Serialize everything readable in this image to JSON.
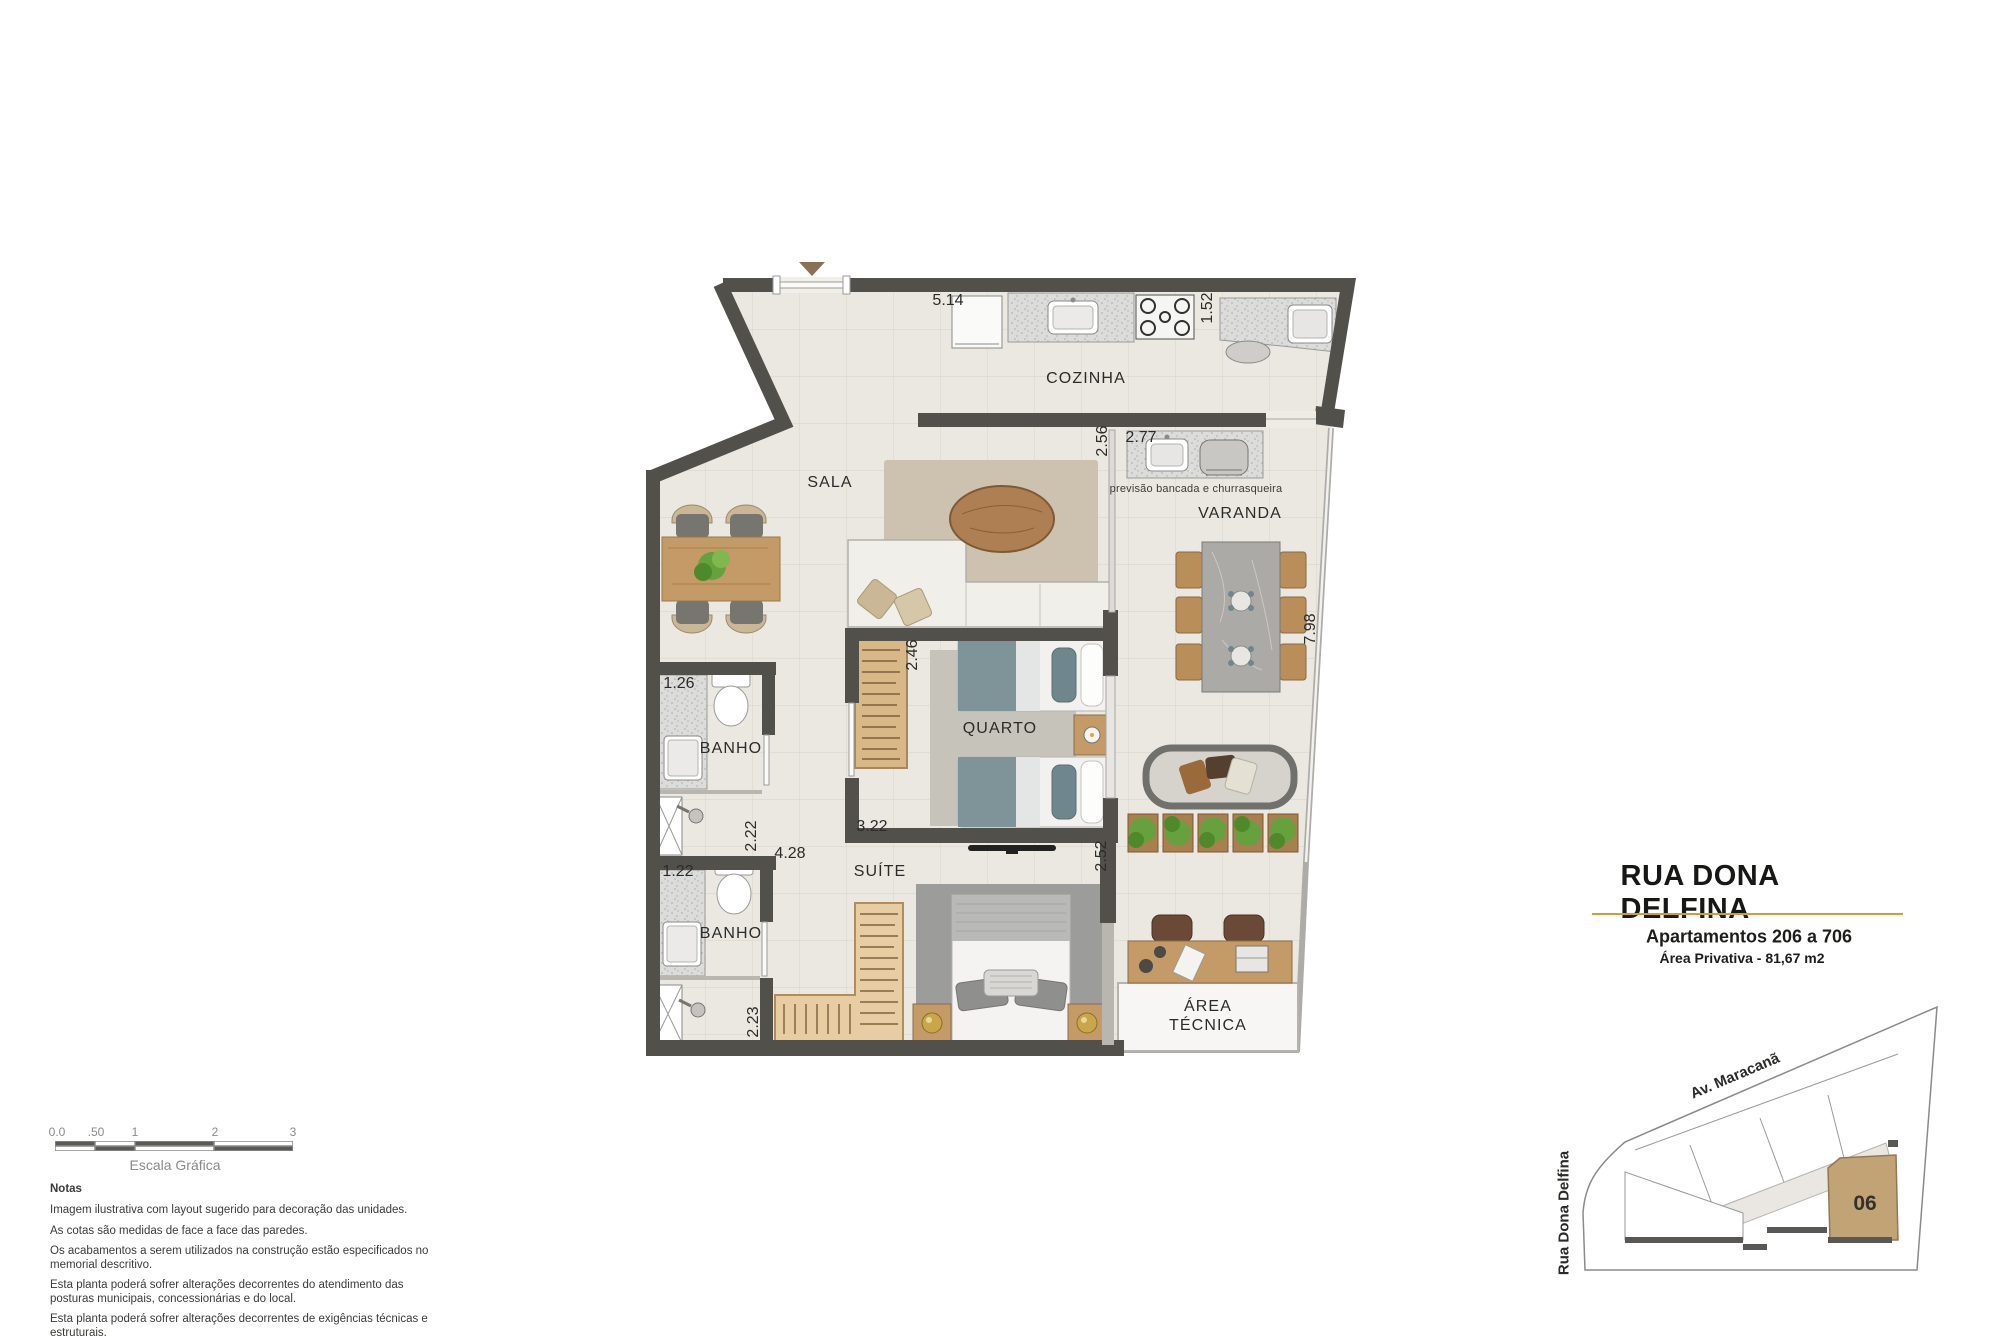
{
  "title_block": {
    "street": "RUA DONA DELFINA",
    "apartments": "Apartamentos 206 a 706",
    "private_area": "Área Privativa - 81,67 m2"
  },
  "plan": {
    "rooms": {
      "cozinha": "COZINHA",
      "sala": "SALA",
      "varanda": "VARANDA",
      "quarto": "QUARTO",
      "suite": "SUÍTE",
      "banho_1": "BANHO",
      "banho_2": "BANHO",
      "area_tecnica_line1": "ÁREA",
      "area_tecnica_line2": "TÉCNICA"
    },
    "annotations": {
      "churrasqueira_note": "previsão bancada e churrasqueira"
    },
    "dimensions": {
      "cozinha_width": "5.14",
      "cozinha_depth": "1.52",
      "sala_depth": "2.56",
      "varanda_bancada": "2.77",
      "varanda_length": "7.98",
      "quarto_depth": "2.46",
      "banho1_width": "1.26",
      "banho1_depth": "2.22",
      "banho2_width": "1.22",
      "banho2_depth": "2.23",
      "suite_width": "4.28",
      "quarto_width": "3.22",
      "quarto_varanda_depth": "2.52"
    }
  },
  "site_map": {
    "street_top": "Av. Maracanã",
    "street_left": "Rua Dona Delfina",
    "unit_number": "06"
  },
  "scale_bar": {
    "ticks": [
      "0.0",
      ".50",
      "1",
      "2",
      "3"
    ],
    "caption": "Escala Gráfica"
  },
  "notes": {
    "heading": "Notas",
    "items": [
      "Imagem ilustrativa com layout sugerido para decoração das unidades.",
      "As cotas são medidas de face a face das paredes.",
      "Os acabamentos a serem utilizados na construção estão especificados no memorial descritivo.",
      "Esta planta poderá sofrer alterações decorrentes do atendimento das posturas municipais, concessionárias e do local.",
      "Esta planta poderá sofrer alterações decorrentes de exigências técnicas e estruturais."
    ]
  },
  "colors": {
    "wall": "#52504b",
    "floor": "#ebe8e1",
    "accent_gold": "#d49c35",
    "unit_highlight": "#c2a376",
    "wood": "#c49a66"
  }
}
